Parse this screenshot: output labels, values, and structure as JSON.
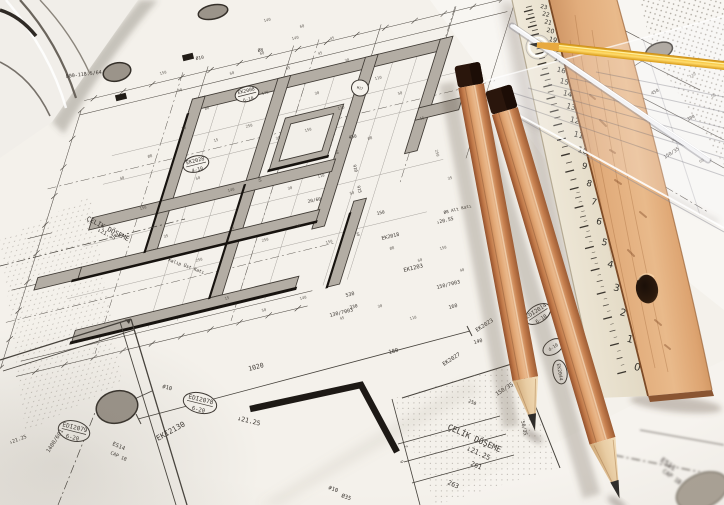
{
  "scene": {
    "type": "photograph",
    "description": "Close-up photograph of architectural structural blueprints (Turkish construction drawings) with two sharpened cedar pencils, a yellow pencil, a transparent set square, a glass rod and a wooden ruler with a cream measuring lath laid on top"
  },
  "palette": {
    "paper": "#f4f1eb",
    "ink": "#3b3631",
    "wall_fill": "#b3ada4",
    "wall_dark": "#17130f",
    "wood_ruler": "#dda471",
    "pencil_wood": "#d08d5c",
    "pencil_cap": "#2a160c",
    "graphite": "#2e2c2a",
    "yellow_pencil": "#f2b31c",
    "scale_face": "#ece4d3",
    "column_gray": "#9b948a"
  },
  "floor_plan": {
    "labels": [
      {
        "text": "ÇELİK DÖŞEME",
        "x": 86,
        "y": 220,
        "rot": 27,
        "size": 6.5
      },
      {
        "text": "↓21.25",
        "x": 97,
        "y": 231,
        "rot": 27,
        "size": 5.5
      },
      {
        "text": "Kalıp Üst Katı",
        "x": 168,
        "y": 261,
        "rot": 20,
        "size": 4.5
      },
      {
        "text": "800-118.5/64",
        "x": 66,
        "y": 78,
        "rot": -7,
        "size": 5
      },
      {
        "text": "Ø10",
        "x": 196,
        "y": 60,
        "rot": -10,
        "size": 4.5
      },
      {
        "text": "Ø8",
        "x": 258,
        "y": 52,
        "rot": -10,
        "size": 4.5
      },
      {
        "text": "450",
        "x": 349,
        "y": 139,
        "rot": -12,
        "size": 4.5
      },
      {
        "text": "910",
        "x": 353,
        "y": 165,
        "rot": 76,
        "size": 4.2
      },
      {
        "text": "915",
        "x": 357,
        "y": 186,
        "rot": 76,
        "size": 4.2
      },
      {
        "text": "20/60",
        "x": 308,
        "y": 203,
        "rot": -12,
        "size": 4.5
      },
      {
        "text": "150",
        "x": 377,
        "y": 215,
        "rot": -12,
        "size": 4.5
      },
      {
        "text": "EK2018",
        "x": 382,
        "y": 240,
        "rot": -14,
        "size": 5
      },
      {
        "text": "EK1203",
        "x": 404,
        "y": 272,
        "rot": -14,
        "size": 5.5
      },
      {
        "text": "150/7003",
        "x": 437,
        "y": 289,
        "rot": -14,
        "size": 5
      },
      {
        "text": "130/7003",
        "x": 330,
        "y": 317,
        "rot": -14,
        "size": 5
      },
      {
        "text": "530",
        "x": 346,
        "y": 297,
        "rot": -14,
        "size": 5
      },
      {
        "text": "330",
        "x": 350,
        "y": 309,
        "rot": -14,
        "size": 4.5
      },
      {
        "text": "180",
        "x": 389,
        "y": 354,
        "rot": -14,
        "size": 5.5
      },
      {
        "text": "160",
        "x": 449,
        "y": 309,
        "rot": -14,
        "size": 5
      },
      {
        "text": "140",
        "x": 474,
        "y": 344,
        "rot": -14,
        "size": 5
      },
      {
        "text": "Ø8 Alt Katı",
        "x": 444,
        "y": 214,
        "rot": -14,
        "size": 4.3
      },
      {
        "text": "↓20.55",
        "x": 437,
        "y": 224,
        "rot": -14,
        "size": 4.8
      },
      {
        "text": "EK2023",
        "x": 477,
        "y": 332,
        "rot": -33,
        "size": 5.5
      },
      {
        "text": "EK2027",
        "x": 444,
        "y": 366,
        "rot": -33,
        "size": 5.5
      },
      {
        "text": "150/35-50",
        "x": 497,
        "y": 396,
        "rot": -33,
        "size": 5.5
      },
      {
        "text": "50/35",
        "x": 521,
        "y": 421,
        "rot": 78,
        "size": 5
      },
      {
        "text": "250",
        "x": 468,
        "y": 402,
        "rot": 24,
        "size": 4.5
      },
      {
        "text": "ÇELİK DÖŞEME",
        "x": 447,
        "y": 429,
        "rot": 24,
        "size": 8
      },
      {
        "text": "↓21.25",
        "x": 466,
        "y": 450,
        "rot": 24,
        "size": 7
      },
      {
        "text": "261",
        "x": 470,
        "y": 465,
        "rot": 24,
        "size": 6.5
      },
      {
        "text": "263",
        "x": 447,
        "y": 484,
        "rot": 24,
        "size": 6.5
      },
      {
        "text": "7",
        "x": 404,
        "y": 446,
        "rot": 70,
        "size": 4.2
      },
      {
        "text": "9",
        "x": 400,
        "y": 461,
        "rot": 70,
        "size": 4.2
      },
      {
        "text": "#10",
        "x": 162,
        "y": 388,
        "rot": 14,
        "size": 5.5
      },
      {
        "text": "#10",
        "x": 328,
        "y": 489,
        "rot": 20,
        "size": 5.5
      },
      {
        "text": "Ø35",
        "x": 341,
        "y": 497,
        "rot": 20,
        "size": 5.5
      },
      {
        "text": "1020",
        "x": 249,
        "y": 371,
        "rot": -15,
        "size": 6.5
      },
      {
        "text": "EKI2130",
        "x": 158,
        "y": 441,
        "rot": -29,
        "size": 7.5
      },
      {
        "text": "ES14",
        "x": 112,
        "y": 445,
        "rot": 24,
        "size": 5.5
      },
      {
        "text": "CAP 1B",
        "x": 110,
        "y": 454,
        "rot": 24,
        "size": 4.8
      },
      {
        "text": "↓21.25",
        "x": 237,
        "y": 420,
        "rot": 14,
        "size": 6.5
      },
      {
        "text": "1400/601",
        "x": 49,
        "y": 453,
        "rot": -57,
        "size": 5.5
      },
      {
        "text": "↓21.25",
        "x": 10,
        "y": 444,
        "rot": -20,
        "size": 5
      },
      {
        "text": "150/35",
        "x": 665,
        "y": 159,
        "rot": -33,
        "size": 4.8
      },
      {
        "text": "450",
        "x": 652,
        "y": 95,
        "rot": -28,
        "size": 4.5
      },
      {
        "text": "300",
        "x": 688,
        "y": 121,
        "rot": -28,
        "size": 4.5
      },
      {
        "text": "E511",
        "x": 660,
        "y": 461,
        "rot": 36,
        "size": 7,
        "blur": true
      },
      {
        "text": "CAP 1B",
        "x": 662,
        "y": 472,
        "rot": 36,
        "size": 6,
        "blur": true
      }
    ],
    "micro_labels": [
      [
        160,
        75,
        -14,
        "150"
      ],
      [
        178,
        92,
        -14,
        "40"
      ],
      [
        205,
        110,
        -14,
        "Ø8"
      ],
      [
        230,
        75,
        -14,
        "60"
      ],
      [
        262,
        95,
        -14,
        "140"
      ],
      [
        286,
        70,
        -14,
        "45"
      ],
      [
        315,
        95,
        -14,
        "30"
      ],
      [
        338,
        110,
        -14,
        "110"
      ],
      [
        182,
        130,
        -14,
        "50"
      ],
      [
        214,
        142,
        -14,
        "15"
      ],
      [
        246,
        128,
        -14,
        "250"
      ],
      [
        276,
        140,
        -14,
        "35"
      ],
      [
        305,
        132,
        -14,
        "150"
      ],
      [
        335,
        150,
        76,
        "40"
      ],
      [
        368,
        140,
        -14,
        "Ø8"
      ],
      [
        196,
        180,
        -14,
        "60"
      ],
      [
        228,
        192,
        -14,
        "140"
      ],
      [
        258,
        178,
        76,
        "45"
      ],
      [
        288,
        190,
        -14,
        "30"
      ],
      [
        318,
        178,
        -14,
        "110"
      ],
      [
        350,
        195,
        -14,
        "50"
      ],
      [
        230,
        230,
        -14,
        "15"
      ],
      [
        262,
        242,
        -14,
        "250"
      ],
      [
        296,
        228,
        -14,
        "35"
      ],
      [
        326,
        244,
        -14,
        "150"
      ],
      [
        356,
        232,
        76,
        "40"
      ],
      [
        390,
        250,
        -14,
        "Ø8"
      ],
      [
        418,
        262,
        -14,
        "60"
      ],
      [
        300,
        300,
        -14,
        "140"
      ],
      [
        340,
        320,
        -14,
        "45"
      ],
      [
        378,
        308,
        -14,
        "30"
      ],
      [
        410,
        320,
        -14,
        "110"
      ],
      [
        262,
        312,
        -14,
        "50"
      ],
      [
        225,
        300,
        -14,
        "15"
      ],
      [
        196,
        262,
        -14,
        "250"
      ],
      [
        164,
        238,
        -14,
        "35"
      ],
      [
        140,
        210,
        -14,
        "150"
      ],
      [
        120,
        180,
        -14,
        "40"
      ],
      [
        148,
        158,
        -14,
        "Ø8"
      ],
      [
        260,
        55,
        -12,
        "60"
      ],
      [
        292,
        40,
        -12,
        "140"
      ],
      [
        318,
        55,
        -12,
        "45"
      ],
      [
        345,
        62,
        -12,
        "30"
      ],
      [
        375,
        80,
        -12,
        "110"
      ],
      [
        398,
        95,
        -12,
        "50"
      ],
      [
        420,
        120,
        -12,
        "15"
      ],
      [
        435,
        150,
        76,
        "250"
      ],
      [
        448,
        180,
        -14,
        "35"
      ],
      [
        440,
        250,
        -14,
        "150"
      ],
      [
        460,
        272,
        -14,
        "40"
      ],
      [
        300,
        28,
        -12,
        "60"
      ],
      [
        330,
        40,
        -12,
        "45"
      ],
      [
        264,
        22,
        -12,
        "140"
      ],
      [
        594,
        62,
        -28,
        "45"
      ],
      [
        618,
        80,
        -28,
        "150"
      ],
      [
        646,
        122,
        -28,
        "40"
      ],
      [
        672,
        142,
        -28,
        "30"
      ],
      [
        700,
        163,
        -28,
        "60"
      ],
      [
        690,
        78,
        -28,
        "110"
      ],
      [
        712,
        98,
        -28,
        "50"
      ]
    ],
    "oval_markers": [
      {
        "lines": [
          "EDI2078",
          "6-20"
        ],
        "x": 200,
        "y": 403,
        "rot": 14,
        "rx": 17,
        "ry": 10
      },
      {
        "lines": [
          "EDI2079",
          "6-20"
        ],
        "x": 74,
        "y": 431,
        "rot": 14,
        "rx": 16,
        "ry": 10
      },
      {
        "lines": [
          "EDI2014",
          "6-10"
        ],
        "x": 538,
        "y": 314,
        "rot": -33,
        "rx": 14,
        "ry": 8.5
      },
      {
        "lines": [
          "d-10"
        ],
        "x": 553,
        "y": 347,
        "rot": -33,
        "rx": 11,
        "ry": 7
      },
      {
        "lines": [
          "EK2028",
          "4-10"
        ],
        "x": 196,
        "y": 164,
        "rot": -14,
        "rx": 13,
        "ry": 8
      },
      {
        "lines": [
          "EK2008",
          "6-10"
        ],
        "x": 247,
        "y": 94,
        "rot": -14,
        "rx": 12,
        "ry": 7.5
      },
      {
        "lines": [
          "EK2044"
        ],
        "x": 560,
        "y": 372,
        "rot": 80,
        "rx": 12,
        "ry": 7
      },
      {
        "lines": [
          "M17"
        ],
        "x": 360,
        "y": 88,
        "rot": 12,
        "rx": 8.5,
        "ry": 8
      }
    ],
    "column_blobs": [
      {
        "x": 117,
        "y": 72,
        "rx": 14,
        "ry": 9,
        "rot": -14
      },
      {
        "x": 213,
        "y": 12,
        "rx": 15,
        "ry": 7,
        "rot": -12
      },
      {
        "x": 659,
        "y": 51,
        "rx": 14,
        "ry": 8,
        "rot": -20
      },
      {
        "x": 117,
        "y": 407,
        "rx": 21,
        "ry": 16,
        "rot": -14
      },
      {
        "x": 702,
        "y": 491,
        "rx": 27,
        "ry": 17,
        "rot": -25,
        "blur": true
      }
    ],
    "black_chips": [
      {
        "x": 188,
        "y": 57
      },
      {
        "x": 121,
        "y": 97
      }
    ]
  },
  "scale_ruler": {
    "numbers": [
      0,
      1,
      2,
      3,
      4,
      5,
      6,
      7,
      8,
      9,
      10,
      11,
      12,
      13,
      14,
      15,
      16,
      17,
      18,
      19,
      20,
      21,
      22,
      23
    ]
  }
}
